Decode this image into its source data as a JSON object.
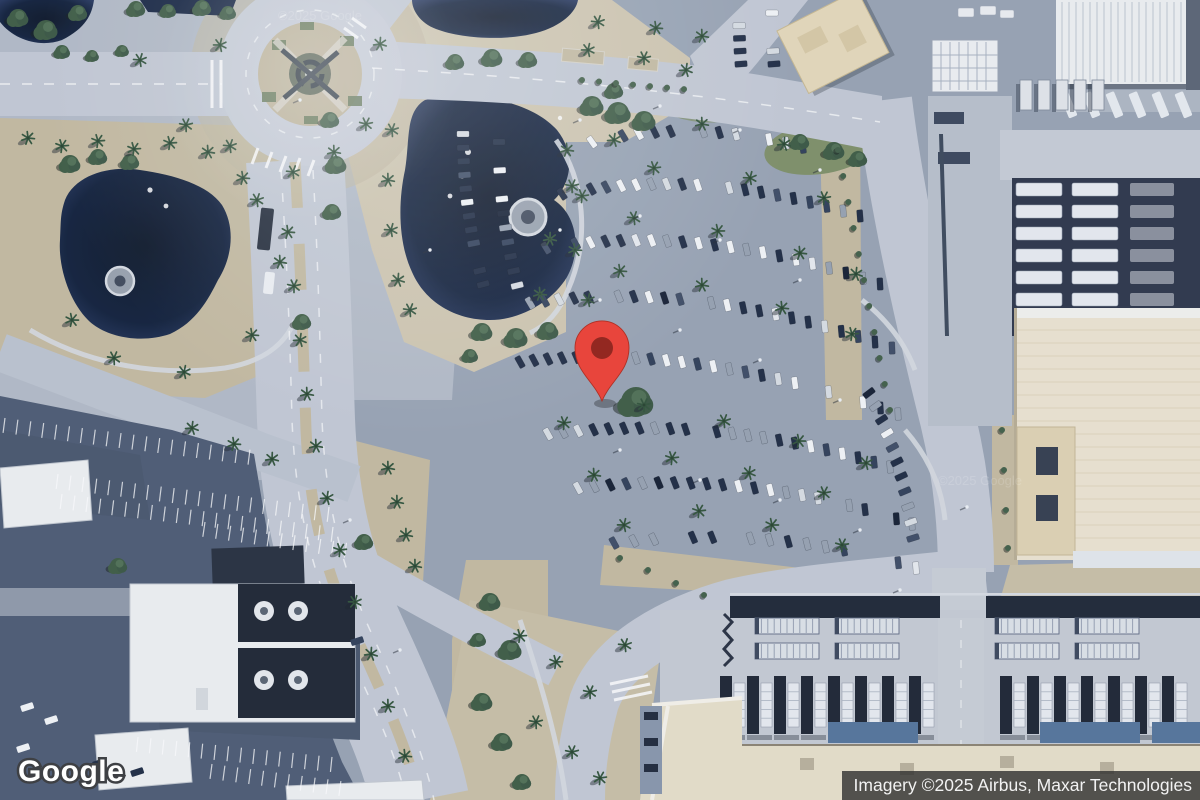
{
  "map": {
    "view": "satellite",
    "logo": "Google",
    "attribution": "Imagery ©2025 Airbus, Maxar Technologies",
    "watermark": "©2025 Google",
    "pin": {
      "x": 602,
      "y": 401,
      "color": "#e8453c",
      "inner": "#8e2720",
      "outline": "#b03024"
    },
    "colors": {
      "water": "#0e1d38",
      "road": "#c3c9d4",
      "road_bright": "#cdd2da",
      "asphalt": "#97a2b2",
      "asphalt_dark": "#4b5971",
      "dirt": "#c4ba9f",
      "dirt_light": "#cfc6ae",
      "grass": "#6d8060",
      "tree": "#3c5a41",
      "palm": "#2f5138",
      "building_white": "#eef0f2",
      "tan_roof": "#e6d9ba",
      "cream_roof": "#ece4d0",
      "blue_roof": "#527399",
      "unit_dark": "#1a2230",
      "attribution_bg": "#323232",
      "attribution_text": "#f2f2f2"
    }
  }
}
